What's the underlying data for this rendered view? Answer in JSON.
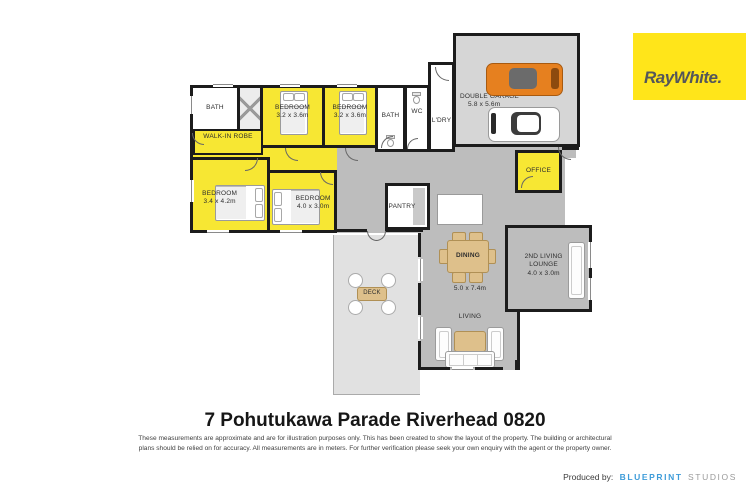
{
  "branding": {
    "logo_text": "RayWhite.",
    "logo_bg": "#FFE51A",
    "produced_by_label": "Produced by:",
    "studio_word1": "BLUEPRINT",
    "studio_word2": "STUDIOS",
    "blueprint_color": "#3E9CD9"
  },
  "footer": {
    "title": "7 Pohutukawa Parade Riverhead 0820",
    "disclaimer1": "These measurements are approximate and are for illustration purposes only. This has been created to show the layout of the property. The building or architectural",
    "disclaimer2": "plans should be relied on for accuracy. All measurements are in meters. For further verification please seek your own enquiry with the agent or the property owner."
  },
  "plan": {
    "colors": {
      "room_yellow": "#F7E733",
      "floor_gray": "#BDBDBD",
      "garage_gray": "#D6D6D6",
      "wall": "#1C1C1C",
      "car_orange": "#E6801F"
    },
    "rooms": {
      "bath1": {
        "label": "BATH"
      },
      "bedroom1": {
        "label": "BEDROOM",
        "dims": "3.2 x 3.6m"
      },
      "bedroom2": {
        "label": "BEDROOM",
        "dims": "3.2 x 3.6m"
      },
      "bath2": {
        "label": "BATH"
      },
      "wc": {
        "label": "WC"
      },
      "ldry": {
        "label": "L'DRY"
      },
      "garage": {
        "label": "DOUBLE GARAGE",
        "dims": "5.8 x 5.6m"
      },
      "office": {
        "label": "OFFICE"
      },
      "walkin_robe": {
        "label": "WALK-IN ROBE"
      },
      "bedroom3": {
        "label": "BEDROOM",
        "dims": "3.4 x 4.2m"
      },
      "bedroom4": {
        "label": "BEDROOM",
        "dims": "4.0 x 3.0m"
      },
      "pantry": {
        "label": "PANTRY"
      },
      "dining": {
        "label": "DINING"
      },
      "living": {
        "label": "LIVING",
        "dims": "5.0 x 7.4m"
      },
      "second_living": {
        "label": "2ND LIVING",
        "label2": "LOUNGE",
        "dims": "4.0 x 3.0m"
      },
      "deck": {
        "label": "DECK"
      }
    }
  }
}
